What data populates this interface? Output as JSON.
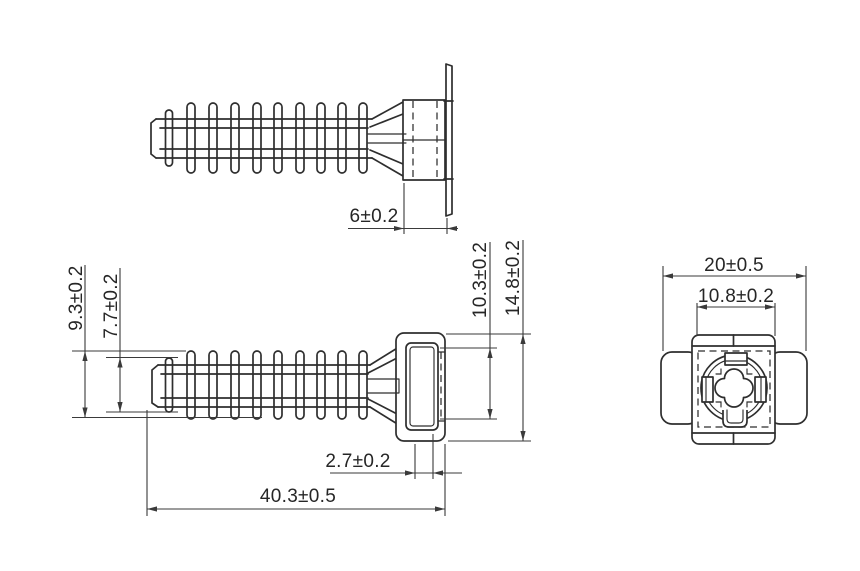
{
  "drawing": {
    "colors": {
      "background": "#ffffff",
      "outline": "#2e2e2e",
      "dimension_line": "#3a3a3a",
      "dimension_text": "#262626"
    },
    "views": {
      "top": {
        "dims": {
          "head_depth": "6±0.2"
        }
      },
      "front": {
        "dims": {
          "large_fin_diameter": "9.3±0.2",
          "small_fin_diameter": "7.7±0.2",
          "slot_opening_height": "10.3±0.2",
          "head_height": "14.8±0.2",
          "slot_depth": "2.7±0.2",
          "overall_length": "40.3±0.5"
        }
      },
      "end": {
        "dims": {
          "overall_width": "20±0.5",
          "body_width": "10.8±0.2"
        }
      }
    }
  }
}
